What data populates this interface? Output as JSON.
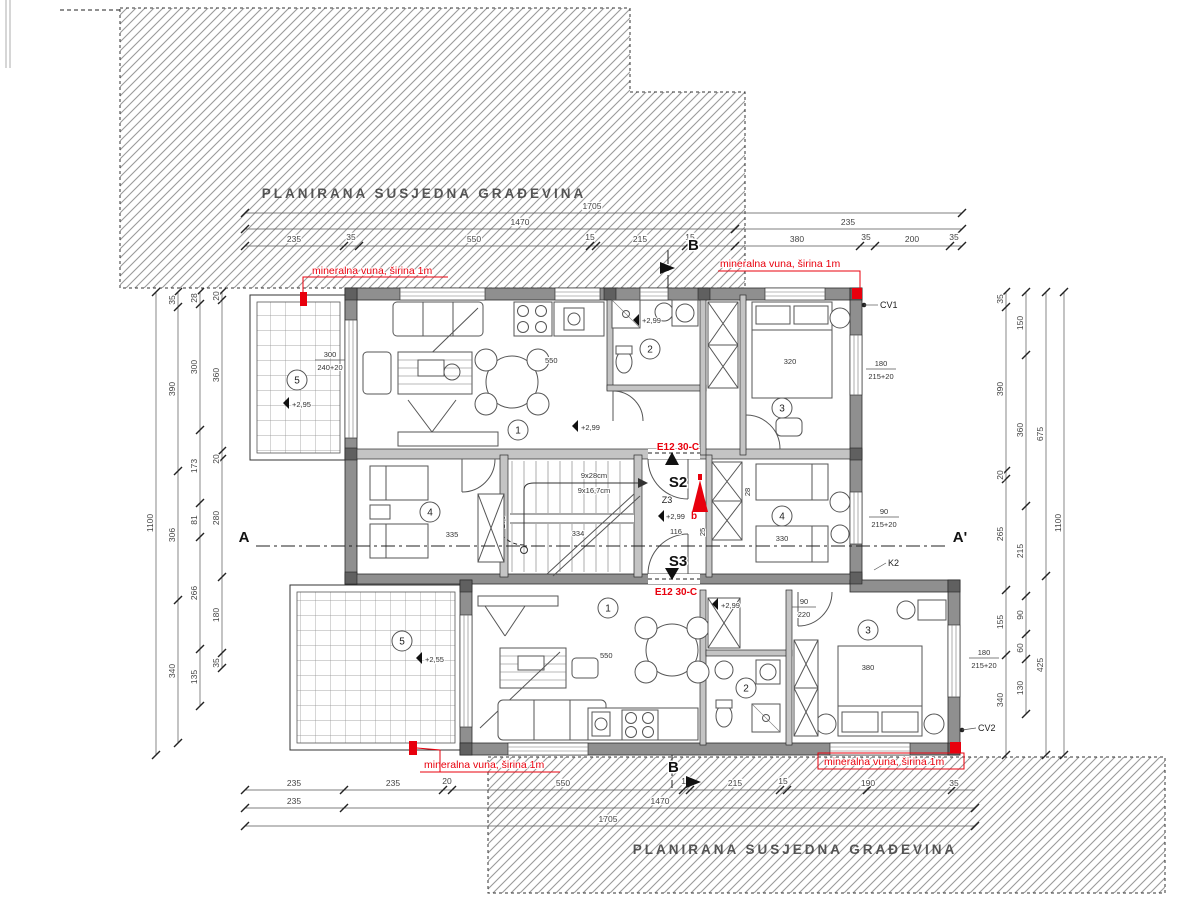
{
  "neighbor": {
    "top_label": "PLANIRANA SUSJEDNA GRAĐEVINA",
    "bottom_label": "PLANIRANA SUSJEDNA GRAĐEVINA"
  },
  "red_notes": {
    "mineral_tl": "mineralna vuna, širina 1m",
    "mineral_tr": "mineralna vuna, širina 1m",
    "mineral_bl": "mineralna vuna, širina 1m",
    "mineral_br": "mineralna vuna, širina 1m",
    "e12_top": "E12 30-C",
    "e12_bottom": "E12 30-C",
    "extinguisher": "b"
  },
  "core": {
    "s2": "S2",
    "s3": "S3",
    "z3": "Z3",
    "dim116": "116",
    "dim334": "334",
    "dim270": "270",
    "dim28": "28",
    "dim25": "25",
    "stair1": "9x28cm",
    "stair2": "9x16,7cm"
  },
  "levels": {
    "living_up": "+2,99",
    "bath_up": "+2,99",
    "core": "+2,99",
    "terrace_up": "+2,95",
    "terrace_low": "+2,55",
    "hall_low": "+2,99"
  },
  "rooms": {
    "u1": "1",
    "u2": "2",
    "u3": "3",
    "u4l": "4",
    "u4r": "4",
    "u5": "5",
    "l1": "1",
    "l2": "2",
    "l3": "3",
    "l5": "5"
  },
  "furniture_dims": {
    "bed_up": "320",
    "bed4l": "335",
    "bed4r": "330",
    "bed_low": "380",
    "living_up": "550",
    "living_low": "550"
  },
  "windows": {
    "w_up_a": "180",
    "w_up_b": "215+20",
    "w_mid_a": "90",
    "w_mid_b": "215+20",
    "w_low_a": "180",
    "w_low_b": "215+20",
    "w_ter_a": "300",
    "w_ter_b": "240+20",
    "door_low_a": "90",
    "door_low_b": "220"
  },
  "refs": {
    "cv1": "CV1",
    "cv2": "CV2",
    "k2": "K2"
  },
  "sections": {
    "a": "A",
    "a2": "A'",
    "b_top": "B",
    "b_bottom": "B"
  },
  "dims": {
    "top1": [
      "1705"
    ],
    "top2": [
      "1470",
      "235"
    ],
    "top3": [
      "235",
      "35",
      "550",
      "15",
      "215",
      "15",
      "380",
      "35",
      "200",
      "35"
    ],
    "bottom1": [
      "235",
      "235",
      "20",
      "550",
      "15",
      "215",
      "15",
      "190",
      "35"
    ],
    "bottom2": [
      "235",
      "1470"
    ],
    "bottom3": [
      "1705"
    ],
    "left_outer": [
      "1100"
    ],
    "leftA": [
      "35",
      "390",
      "306",
      "340"
    ],
    "leftB": [
      "28",
      "300",
      "173",
      "81",
      "266",
      "135"
    ],
    "leftC": [
      "20",
      "360",
      "20",
      "280",
      "180",
      "35"
    ],
    "rightA": [
      "35",
      "390",
      "20",
      "265",
      "155",
      "340"
    ],
    "rightB": [
      "150",
      "360",
      "215",
      "90",
      "60",
      "130"
    ],
    "rightC": [
      "675",
      "425"
    ],
    "right_outer": [
      "1100"
    ]
  }
}
